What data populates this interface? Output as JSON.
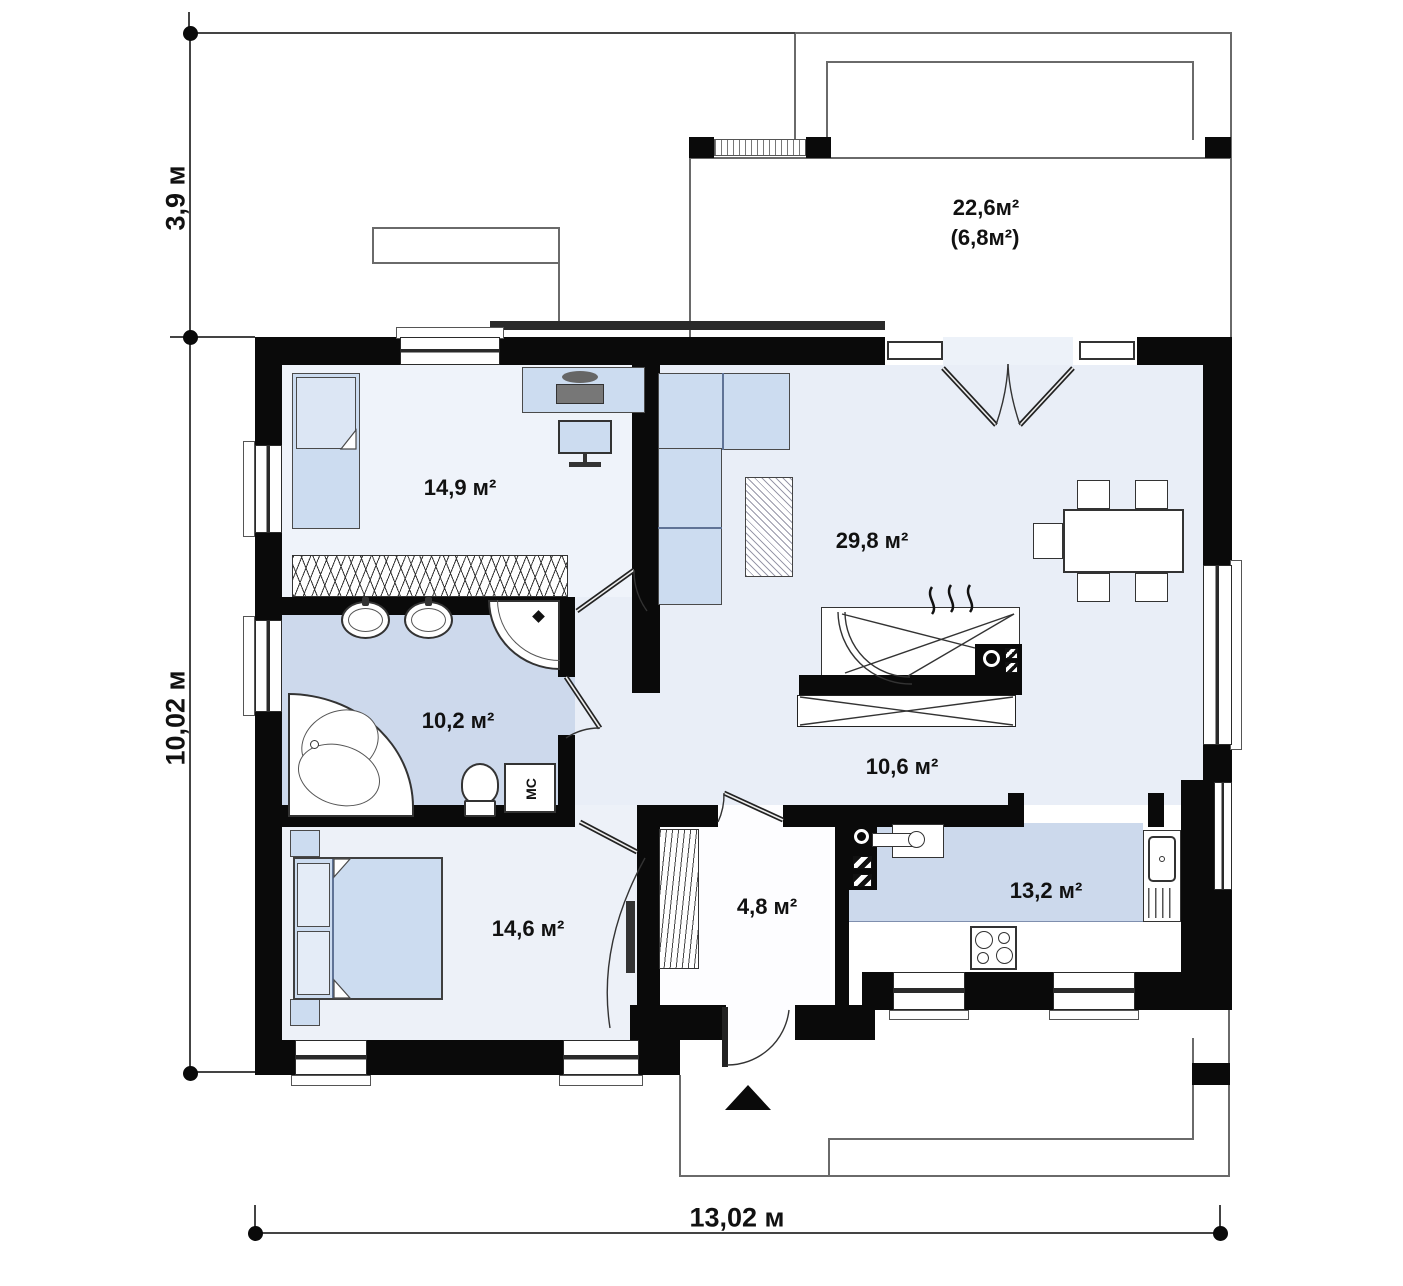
{
  "plan": {
    "dimensions": {
      "top_left_height": "3,9 м",
      "left_height": "10,02 м",
      "bottom_width": "13,02 м"
    },
    "rooms": {
      "bedroom1": "14,9 м²",
      "living": "29,8 м²",
      "bathroom": "10,2 м²",
      "hall": "10,6 м²",
      "bedroom2": "14,6 м²",
      "hallway": "4,8 м²",
      "kitchen": "13,2 м²",
      "terrace": "22,6м²",
      "terrace_secondary": "(6,8м²)"
    },
    "labels": {
      "washing_machine": "МС"
    },
    "colors": {
      "wall": "#0a0a0a",
      "floor_bedroom": "#eff3fa",
      "floor_living": "#e9eef7",
      "floor_bathroom": "#cdd9ec",
      "floor_kitchen_counter": "#ccd9ec",
      "furniture": "#ccdcf0",
      "outline": "#6a6a6a"
    }
  }
}
